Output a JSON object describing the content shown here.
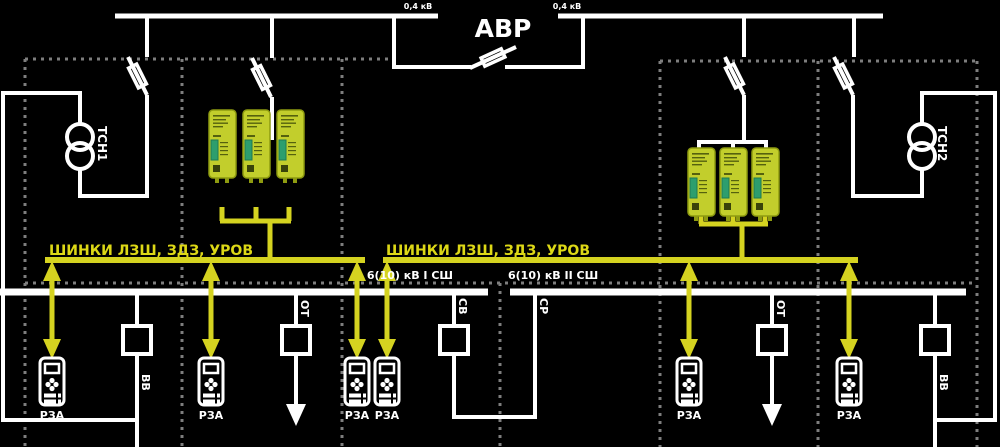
{
  "diagram": {
    "top": {
      "avr": "АВР",
      "v04_left": "0,4 кВ",
      "v04_right": "0,4 кВ"
    },
    "transformers": {
      "tsn1": "ТСН1",
      "tsn2": "ТСН2"
    },
    "logic_bus": {
      "label_left": "ШИНКИ ЛЗШ, ЗДЗ, УРОВ",
      "label_right": "ШИНКИ ЛЗШ, ЗДЗ, УРОВ"
    },
    "sections": {
      "bus1": "6(10) кВ I СШ",
      "bus2": "6(10) кВ II СШ"
    },
    "switch_labels": {
      "vv1": "ВВ",
      "ot1": "ОТ",
      "sv": "СВ",
      "sr": "СР",
      "ot2": "ОТ",
      "vv2": "ВВ"
    },
    "rza": {
      "label": "РЗА"
    },
    "colors": {
      "background": "#000000",
      "line_white": "#ffffff",
      "accent_yellow": "#d5d320",
      "dashed_gray": "#7e7e7e",
      "device_body": "#c2ce2c",
      "device_border": "#8e9b10",
      "device_connector": "#2d9e6e"
    }
  }
}
